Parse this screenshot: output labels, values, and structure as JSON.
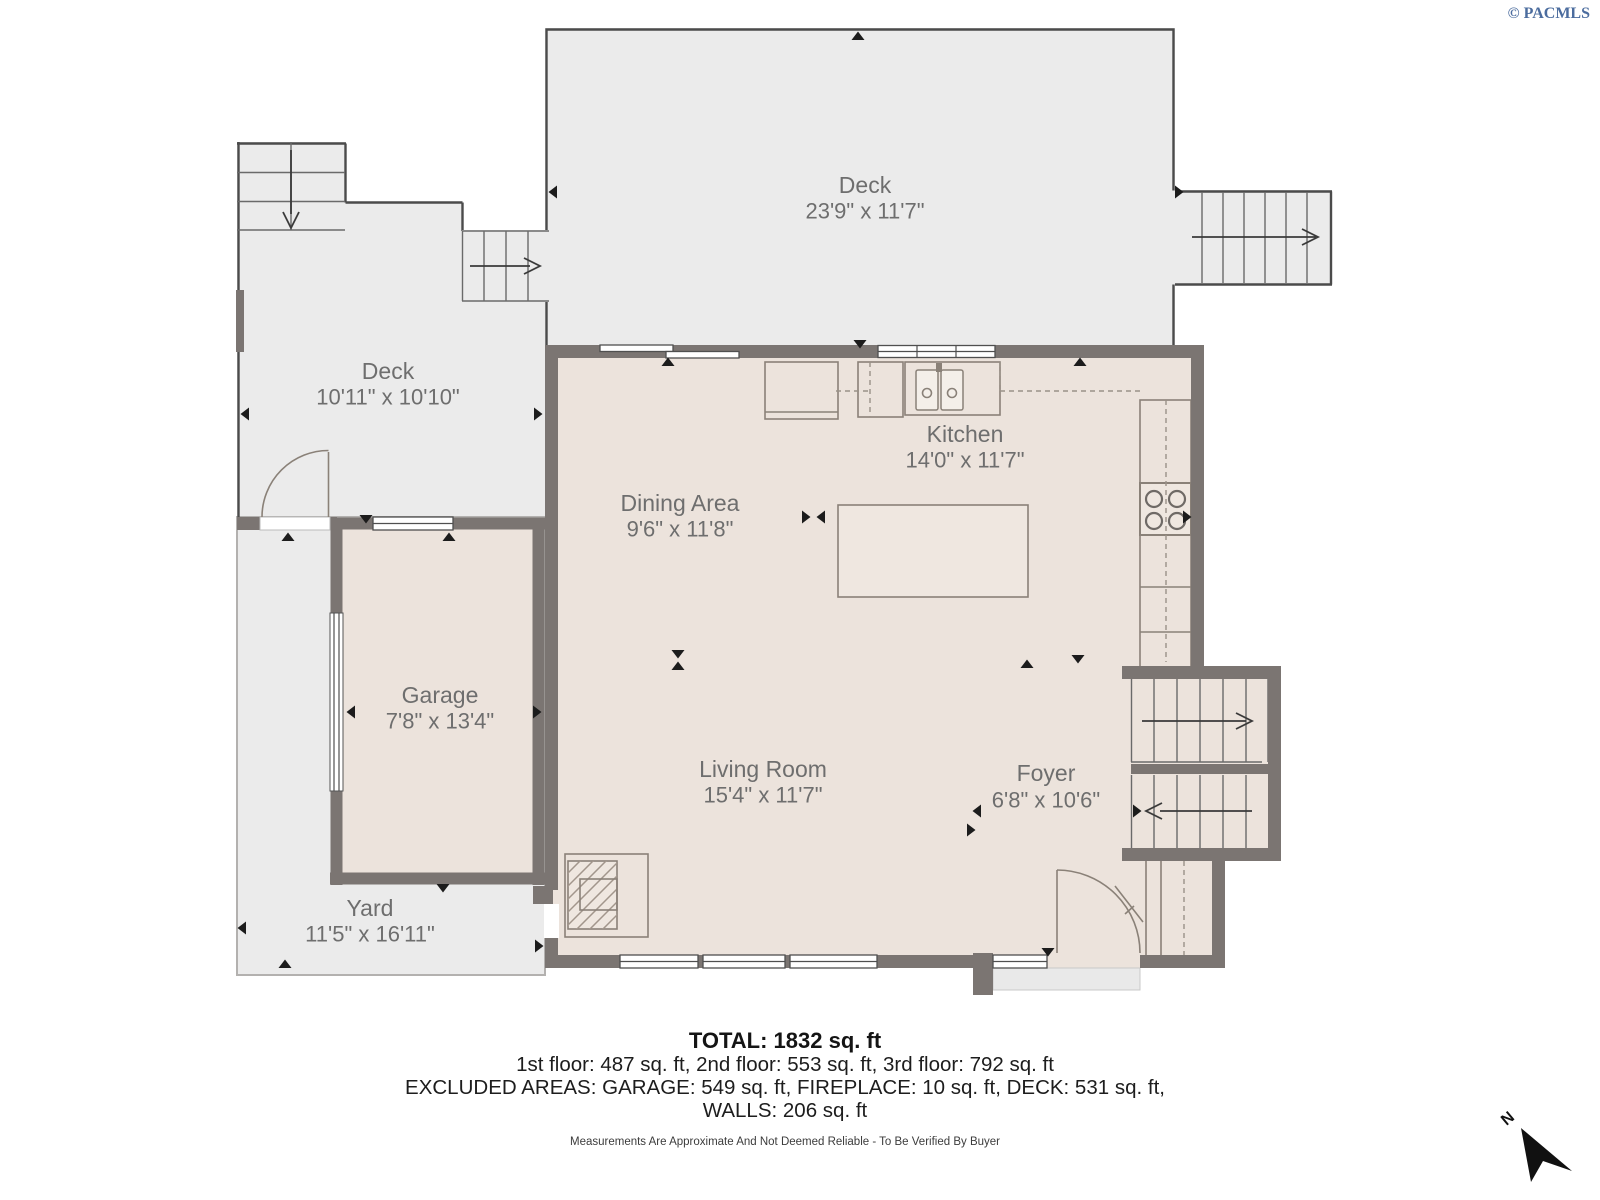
{
  "header": {
    "copyright": "© PACMLS"
  },
  "rooms": {
    "deck_top": {
      "name": "Deck",
      "dims": "23'9\" x 11'7\""
    },
    "deck_left": {
      "name": "Deck",
      "dims": "10'11\" x 10'10\""
    },
    "kitchen": {
      "name": "Kitchen",
      "dims": "14'0\" x 11'7\""
    },
    "dining": {
      "name": "Dining Area",
      "dims": "9'6\" x 11'8\""
    },
    "garage": {
      "name": "Garage",
      "dims": "7'8\" x 13'4\""
    },
    "living": {
      "name": "Living Room",
      "dims": "15'4\" x 11'7\""
    },
    "foyer": {
      "name": "Foyer",
      "dims": "6'8\" x 10'6\""
    },
    "yard": {
      "name": "Yard",
      "dims": "11'5\" x 16'11\""
    }
  },
  "summary": {
    "total": "TOTAL: 1832 sq. ft",
    "floors": "1st floor: 487 sq. ft, 2nd floor: 553 sq. ft, 3rd floor: 792 sq. ft",
    "excluded": "EXCLUDED AREAS: GARAGE: 549 sq. ft, FIREPLACE: 10 sq. ft, DECK: 531 sq. ft,",
    "walls": "WALLS: 206 sq. ft",
    "disclaimer": "Measurements Are Approximate And Not Deemed Reliable - To Be Verified By Buyer"
  },
  "compass": {
    "label": "N"
  },
  "colors": {
    "wall": "#7b7572",
    "interior_floor": "#ece3dc",
    "deck_floor": "#ebebeb",
    "label_text": "#6e6e6e",
    "copyright_blue": "#4b6c9e"
  }
}
